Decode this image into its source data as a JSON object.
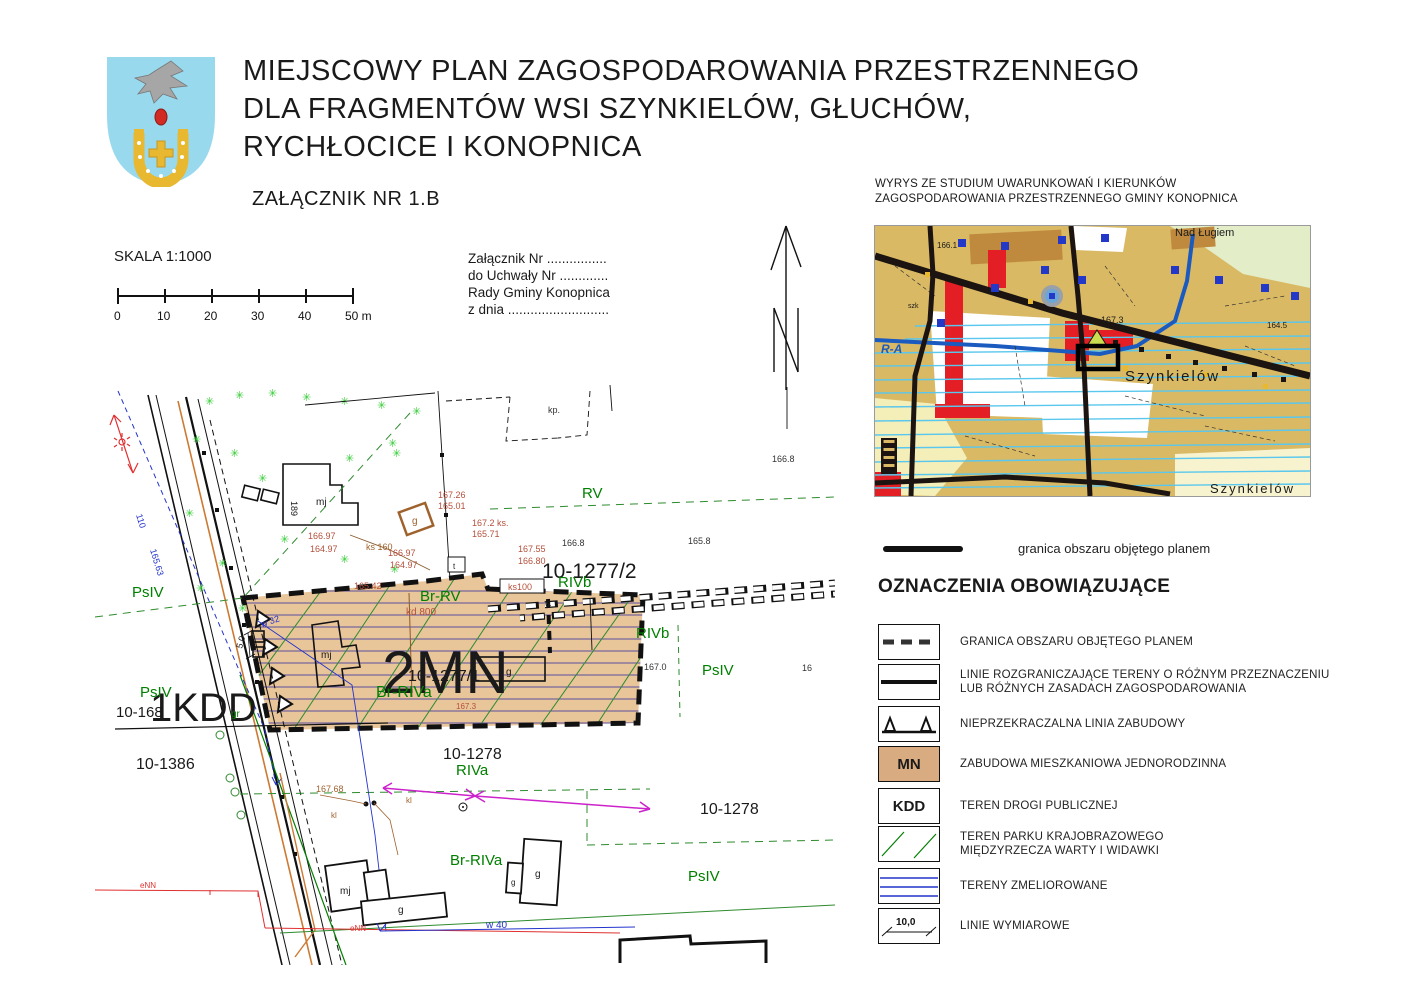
{
  "header": {
    "title_line1": "MIEJSCOWY PLAN ZAGOSPODAROWANIA PRZESTRZENNEGO",
    "title_line2": "DLA FRAGMENTÓW WSI SZYNKIELÓW, GŁUCHÓW,",
    "title_line3": "RYCHŁOCICE I KONOPNICA",
    "attachment_label": "ZAŁĄCZNIK NR 1.B"
  },
  "scale": {
    "label": "SKALA 1:1000",
    "ticks": [
      "0",
      "10",
      "20",
      "30",
      "40",
      "50 m"
    ]
  },
  "note": {
    "line1": "Załącznik Nr ................",
    "line2": "do Uchwały Nr .............",
    "line3": "Rady Gminy Konopnica",
    "line4": "z dnia ..........................."
  },
  "study": {
    "title_line1": "WYRYS ZE STUDIUM UWARUNKOWAŃ I KIERUNKÓW",
    "title_line2": "ZAGOSPODAROWANIA PRZESTRZENNEGO GMINY KONOPNICA",
    "boundary_label": "granica obszaru objętego planem",
    "inset": {
      "nad_lugiem": "Nad Ługiem",
      "szynkielow": "Szynkielów",
      "szynkielow2": "Szynkielów",
      "ra": "R-A",
      "szk": "szk",
      "e1673": "167.3",
      "e1661": "166.1",
      "e1645": "164.5"
    }
  },
  "legend": {
    "heading": "OZNACZENIA OBOWIĄZUJĄCE",
    "items": [
      {
        "label": "GRANICA OBSZARU OBJĘTEGO PLANEM"
      },
      {
        "label": "LINIE ROZGRANICZAJĄCE TERENY O RÓŻNYM PRZEZNACZENIU",
        "label2": "LUB RÓŻNYCH ZASADACH ZAGOSPODAROWANIA"
      },
      {
        "label": "NIEPRZEKRACZALNA LINIA ZABUDOWY"
      },
      {
        "symbol": "MN",
        "label": "ZABUDOWA MIESZKANIOWA JEDNORODZINNA"
      },
      {
        "symbol": "KDD",
        "label": "TEREN DROGI PUBLICZNEJ"
      },
      {
        "label": "TEREN PARKU KRAJOBRAZOWEGO",
        "label2": "MIĘDZYRZECZA WARTY I WIDAWKI"
      },
      {
        "label": "TERENY  ZMELIOROWANE"
      },
      {
        "symbol": "10,0",
        "label": "LINIE WYMIAROWE"
      }
    ]
  },
  "map": {
    "labels": {
      "zone_mn": "2MN",
      "zone_kdd": "1KDD",
      "p12772": "10-1277/2",
      "p12771": "10-1277/1",
      "p1278": "10-1278",
      "p1386": "10-1386",
      "p168": "10-168",
      "rv": "RV",
      "rivb": "RIVb",
      "riva": "RIVa",
      "br_rv": "Br-RV",
      "br_riva": "Br-RIVa",
      "psiv": "PsIV",
      "gr": "gr",
      "e1668": "166.8",
      "e1658": "165.8",
      "e1670": "167.0",
      "e1673": "167.3",
      "e16_part": "16",
      "e16726": "167.26",
      "e16501": "165.01",
      "e16697": "166.97",
      "e16497": "164.97",
      "e1672ks": "167.2 ks.",
      "e16571": "165.71",
      "e16755": "167.55",
      "e16680": "166.80",
      "e16542": "165.42",
      "e16768": "167.68",
      "ks160": "ks 160",
      "ks100": "ks100",
      "kd800": "kd 800",
      "w32": "w 32",
      "w40": "w 40",
      "enn": "eNN",
      "e110": "110",
      "e16563": "165.63",
      "kl": "kl",
      "kp": "kp.",
      "dim50": "5,0",
      "mj": "mj",
      "b189": "189",
      "g": "g",
      "t": "t",
      "w_dot": "w."
    }
  },
  "colors": {
    "zone_fill": "#e9c59a",
    "legend_mn_fill": "#d9ab80",
    "soil_green": "#008000",
    "elevation_red": "#b5503c",
    "utility_brown": "#a0622d",
    "line_blue": "#2233cc",
    "melioration_purple": "#5b4fa0",
    "melioration_cyan": "#59c7ee",
    "magenta": "#cc22cc",
    "orange": "#cc7a33",
    "inset_tan": "#d9b964",
    "inset_green": "#e3edc8",
    "inset_red": "#e31e24",
    "inset_blue": "#1b5bbf",
    "crest_blue": "#99d9ee",
    "crest_gold": "#e8b830"
  }
}
